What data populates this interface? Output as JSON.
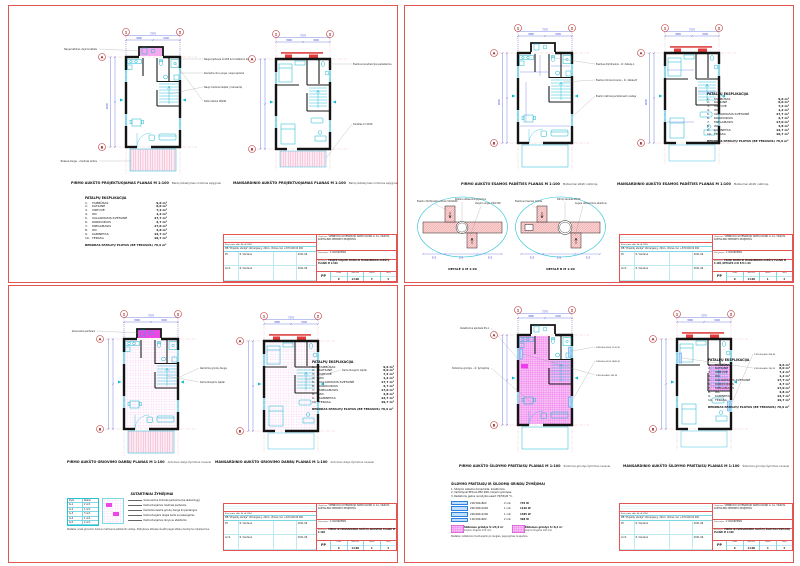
{
  "grid": {
    "axes_top": [
      "1",
      "2"
    ],
    "axes_side": [
      "A",
      "B"
    ]
  },
  "dims": {
    "top1": "3980",
    "top2": "3290",
    "top_total": "7270",
    "left1": "4480",
    "left2": "4520",
    "left_total": "9000"
  },
  "explication": {
    "title": "PATALPŲ EKSPLIKACIJA",
    "rooms": [
      {
        "nr": "1.",
        "name": "TAMBŪRAS",
        "area": "9,6 m²"
      },
      {
        "nr": "2.",
        "name": "KATILINĖ",
        "area": "6,0 m²"
      },
      {
        "nr": "3.",
        "name": "VIRTUVĖ",
        "area": "7,2 m²"
      },
      {
        "nr": "4.",
        "name": "WC",
        "area": "1,2 m²"
      },
      {
        "nr": "5.",
        "name": "VALGOMASIS-SVETAINĖ",
        "area": "17,7 m²"
      },
      {
        "nr": "6.",
        "name": "KORIDORIUS",
        "area": "2,7 m²"
      },
      {
        "nr": "7.",
        "name": "MIEGAMASIS",
        "area": "17,0 m²"
      },
      {
        "nr": "8.",
        "name": "WC",
        "area": "4,8 m²"
      },
      {
        "nr": "9.",
        "name": "KABINETAS",
        "area": "12,7 m²"
      },
      {
        "nr": "10.",
        "name": "TERASA",
        "area": "19,7 m²"
      }
    ],
    "total": "BENDRAS PATALPŲ PLOTAS (BE TERASOS) 78,9 m²"
  },
  "sheets": {
    "tl": {
      "caption1": "PIRMO AUKŠTO PROJEKTUOJAMAS PLANAS M 1:100",
      "caption1_note": "Baldų išdėstymas rodomas sąlyginai",
      "caption2": "MANSARDINIO AUKŠTO PROJEKTUOJAMAS PLANAS M 1:100",
      "caption2_note": "Baldų išdėstymas rodomas sąlyginai",
      "ann_right": [
        "Nauja pertvara iš GKP ant metalinio karkaso",
        "Keičiama durų anga, nauja sąrama",
        "Nauji mediniai laiptai į mansardą",
        "Dušo kabina 90x90"
      ],
      "ann_left": [
        "Nauja katilinė, dujinis katilas",
        "Terasos danga – medinės lentos"
      ],
      "ann2": [
        "Esamos konstrukcijos paliekamos",
        "Turėklas h=1100"
      ],
      "drawing": "PROJEKTUOJAMI PIRMO IR MANSARDINIO AUKŠTŲ PLANAI M 1:100",
      "lapas": "3"
    },
    "tr": {
      "caption1": "PIRMO AUKŠTO ESAMOS PADĖTIES PLANAS M 1:100",
      "caption1_note": "Matavimai atlikti natūroje",
      "caption2": "MANSARDINIO AUKŠTO ESAMOS PADĖTIES PLANAS M 1:100",
      "caption2_note": "Matavimai atlikti natūroje",
      "ann": [
        "Esamas dūmtraukis – žr. detalę A",
        "Esama mūrinė krosnis – žr. detalę B",
        "Esami matmenys tikslinami vietoje"
      ],
      "det_a": "DETALĖ A M 1:20",
      "det_b": "DETALĖ B M 1:20",
      "det_a_ann": [
        "Esamo dūmtraukio mūras 510x640",
        "Pakūra užtaisoma plytomis",
        "Valymo anga 130x130"
      ],
      "det_b_ann": [
        "Esamos krosnies mūras",
        "Dūmų kanalas Ø150",
        "Angos užtaisomos skiediniu"
      ],
      "det_dims": [
        "510",
        "250",
        "510"
      ],
      "drawing": "ESAMI PIRMO IR MANSARDINIO AUKŠTŲ PLANAI M 1:100, DETALĖS A IR B M 1:20",
      "lapas": "1"
    },
    "bl": {
      "caption1": "PIRMO AUKŠTO GRIOVIMO DARBŲ PLANAS M 1:100",
      "caption1_note": "Ardomos dalys žymimos rausvai",
      "caption2": "MANSARDINIO AUKŠTO GRIOVIMO DARBŲ PLANAS M 1:100",
      "caption2_note": "Ardomos dalys žymimos rausvai",
      "ann": [
        "Griaunama pertvara",
        "Išardoma grindų danga",
        "Demontuojami laiptai"
      ],
      "legend": {
        "title": "SUTARTINIAI ŽYMĖJIMAI",
        "table": [
          [
            "Žym.",
            "Kiekis"
          ],
          [
            "G-1",
            "2 vnt."
          ],
          [
            "G-2",
            "1 vnt."
          ],
          [
            "G-3",
            "3 vnt."
          ],
          [
            "G-4",
            "1 vnt."
          ],
          [
            "G-5",
            "2 vnt."
          ]
        ],
        "descs": [
          "Griaunamos mūrinės pertvaros (be laikančiųjų)",
          "Demontuojamos medinės pertvaros",
          "Išardoma esama grindų danga iki perdangos",
          "Demontuojami langai kartu su palangėmis",
          "Demontuojamos durys su staktomis"
        ],
        "note": "Pastaba: prieš griovimo darbus matmenis patikslinti vietoje. Statybines atliekas išvežti pagal atliekų tvarkymo reikalavimus."
      },
      "drawing": "PIRMO IR MANSARDINIO AUKŠTŲ GRIOVIMO PLANAI M 1:100",
      "lapas": "2"
    },
    "br": {
      "caption1": "PIRMO AUKŠTO ŠILDYMO PRIETAISŲ PLANAS M 1:100",
      "caption1_note": "Šildomos grindys žymimos rausvai",
      "caption2": "MANSARDINIO AUKŠTO ŠILDYMO PRIETAISŲ PLANAS M 1:100",
      "caption2_note": "Šildomos grindys žymimos rausvai",
      "ann": [
        "Kolektorinė spintelė KS-1",
        "Šildomos grindys – žr. žymėjimą"
      ],
      "tags1": [
        "21K-500x800  745 W",
        "22K-500x1000  1120 W",
        "22K-600x1200  1485 W"
      ],
      "tags2": [
        "11K-500x600  398 W",
        "21K-500x800  745 W"
      ],
      "legend": {
        "title": "ŠILDYMO PRIETAISŲ IR ŠILDOMŲ GRINDŲ ŽYMĖJIMAI",
        "notes": [
          "1. Šildymo sistema dvivamzdė, kolektorinė.",
          "2. Vamzdynai PEX-AL-PEX Ø16, klojami grindyse.",
          "3. Radiatorių galios nurodytos esant 70/55/20 °C."
        ],
        "rows": [
          {
            "label": "21K-500x800",
            "qty": "2 vnt.",
            "power": "745 W"
          },
          {
            "label": "22K-500x1000",
            "qty": "1 vnt.",
            "power": "1120 W"
          },
          {
            "label": "22K-600x1200",
            "qty": "1 vnt.",
            "power": "1485 W"
          },
          {
            "label": "11K-500x600",
            "qty": "2 vnt.",
            "power": "398 W"
          }
        ],
        "samples": [
          {
            "title": "Šildomos grindys S=24,6 m²",
            "desc": "klojimo žingsnis 150 mm"
          },
          {
            "title": "Šildomos grindys S=8,2 m²",
            "desc": "klojimo žingsnis 100 mm"
          }
        ],
        "note": "Pastaba: radiatoriai montuojami po langais, pajungimas iš apačios."
      },
      "drawing": "PIRMO IR MANSARDINIO AUKŠTŲ ŠILDYMO PRIETAISŲ PLANAI M 1:100",
      "lapas": "4"
    }
  },
  "titleblock": {
    "attest": "Kval. patv. dok. Nr. A 2134",
    "company": "MB \"Projektų studija\"",
    "address": "Ukmergės g. 220-1, Vilnius, tel. +370 600 00 000",
    "roles": [
      [
        "PV",
        "R. Vardenė"
      ],
      [
        "Arch.",
        "R. Vardenė"
      ]
    ],
    "date": "2021-06",
    "object_label": "Objektas:",
    "object": "VIENBUČIO GYVENAMOJO NAMO KAUNO G. 1A, VILNIUS, KAPITALINIO REMONTO PROJEKTAS",
    "client_label": "Statytojas:",
    "client": "V. PAVARDENIS",
    "drawing_label": "Brėžinys:",
    "stage": "PP",
    "mini_headers": [
      "Laida",
      "Mastelis",
      "Lapas",
      "Lapų"
    ],
    "mini": {
      "laida": "0",
      "mastelis": "1:100",
      "lapu": "4"
    }
  }
}
